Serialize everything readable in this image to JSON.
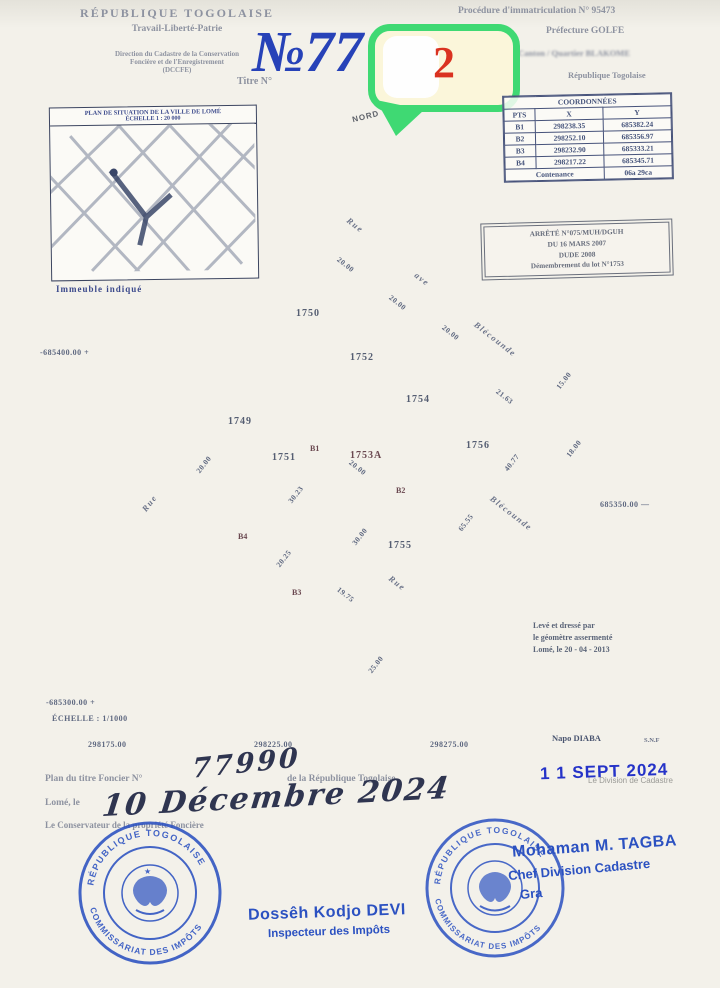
{
  "header": {
    "rep": "RÉPUBLIQUE  TOGOLAISE",
    "motto": "Travail-Liberté-Patrie",
    "dir1": "Direction du Cadastre de la Conservation",
    "dir2": "Foncière et de l'Enregistrement",
    "dir3": "(DCCFE)",
    "titre": "Titre N°",
    "numero": "№77",
    "bubble_value": "2",
    "r1": "Procédure d'immatriculation  N°  95473",
    "r2": "Préfecture   GOLFE",
    "r3": "Canton  /  Quartier  BLAKOME",
    "r4": "République Togolaise"
  },
  "coords": {
    "title": "COORDONNÉES",
    "c0": "PTS",
    "c1": "X",
    "c2": "Y",
    "rows": [
      [
        "B1",
        "298238.35",
        "685382.24"
      ],
      [
        "B2",
        "298252.10",
        "685356.97"
      ],
      [
        "B3",
        "298232.90",
        "685333.21"
      ],
      [
        "B4",
        "298217.22",
        "685345.71"
      ]
    ],
    "cont_label": "Contenance",
    "cont_value": "06a  29ca"
  },
  "inset": {
    "t1": "PLAN DE SITUATION DE LA VILLE DE LOMÉ",
    "t2": "ÉCHELLE  1 : 20 000",
    "caption": "Immeuble indiqué"
  },
  "arrete": {
    "l1": "ARRÊTÉ N°075/MUH/DGUH",
    "l2": "DU 16 MARS 2007",
    "l3": "DUDE 2008",
    "l4": "Démembrement du lot N°1753"
  },
  "plan": {
    "north": "NORD",
    "parcels": [
      "1750",
      "1752",
      "1754",
      "1756",
      "1749",
      "1751",
      "1753A",
      "1755"
    ],
    "points": [
      "B1",
      "B2",
      "B3",
      "B4"
    ],
    "streets": [
      "Rue",
      "ave",
      "Blécounde",
      "Rue",
      "Blécounde",
      "Rue"
    ],
    "dims": [
      "20.00",
      "20.00",
      "20.00",
      "21.63",
      "15.00",
      "18.00",
      "40.77",
      "65.55",
      "20.00",
      "30.00",
      "30.23",
      "19.75",
      "20.25",
      "20.00",
      "25.00"
    ],
    "axis": {
      "left_top": "-685400.00   +",
      "left_bottom": "-685300.00   +",
      "scale": "ÉCHELLE : 1/1000",
      "right": "685350.00 —",
      "bottom": [
        "298175.00",
        "298225.00",
        "298275.00"
      ]
    }
  },
  "surveyor": {
    "l1": "Levé et dressé par",
    "l2": "le géomètre assermenté",
    "l3": "Lomé, le 20 - 04 - 2013",
    "name": "Napo  DIABA",
    "ref": "S.N.F"
  },
  "footer": {
    "l1a": "Plan  du  titre  Foncier  N°",
    "hand_no": "77990",
    "l1b": "de  la  République  Togolaise",
    "l2": "Lomé,  le",
    "hand_date": "10 Décembre 2024",
    "l3": "Le   Conservateur   de   la   propriété   Foncière"
  },
  "stamps": {
    "left_round_top": "RÉPUBLIQUE TOGOLAISE",
    "left_round_bottom": "COMMISSARIAT DES IMPÔTS",
    "left_name": "Dossêh Kodjo DEVI",
    "left_role": "Inspecteur des Impôts",
    "date_stamp": "1 1 SEPT 2024",
    "faint_line": "Le Division de Cadastre",
    "right_name": "Mohaman M. TAGBA",
    "right_role": "Chef Division Cadastre",
    "right_fragment": "Gra",
    "right_round_top": "RÉPUBLIQUE TOGOLAISE",
    "right_round_bottom": "COMMISSARIAT DES IMPÔTS"
  }
}
